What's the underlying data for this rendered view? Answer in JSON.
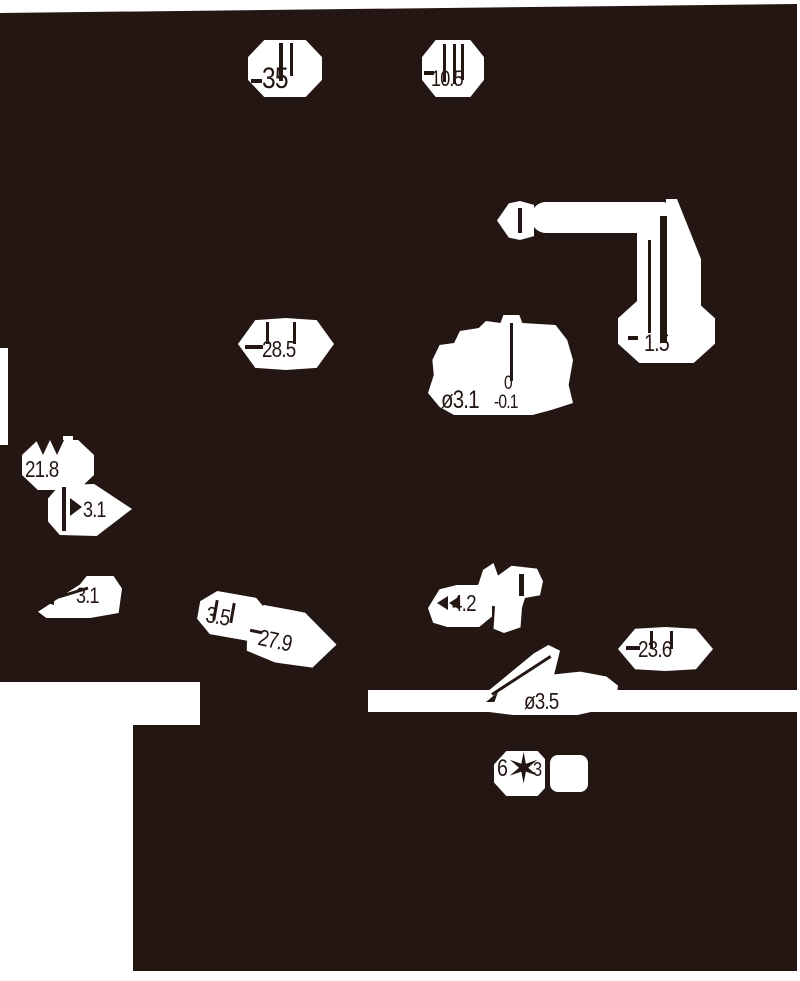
{
  "drawing": {
    "type": "mechanical-part-dimension-drawing",
    "dimensions": {
      "d35": "35",
      "d105": "10.5",
      "d15": "1.5",
      "d285": "28.5",
      "dia31": "ø3.1",
      "tol_upper": "0",
      "tol_lower": "-0.1",
      "d218": "21.8",
      "d31a": "3.1",
      "d31b": "3.1",
      "d35b": "3.5",
      "d279": "27.9",
      "d42": "4.2",
      "d236": "23.6",
      "dia35": "ø3.5",
      "d63_left": "6",
      "d63_right": "3"
    },
    "icons": {
      "starburst": "✶"
    },
    "colors": {
      "background": "#241713",
      "paper": "#ffffff"
    }
  }
}
